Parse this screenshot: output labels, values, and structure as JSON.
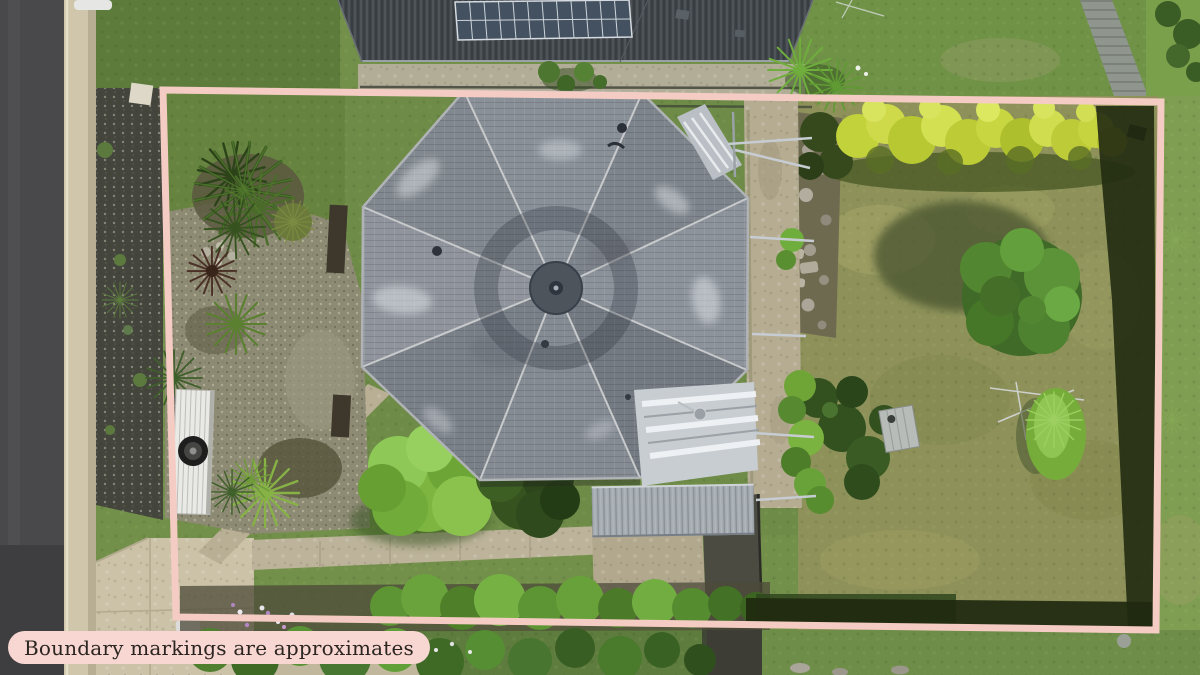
{
  "overlay": {
    "boundary_label": "Boundary markings are approximates",
    "boundary_color": "#f5ccc4",
    "label_background": "#f8d6d1",
    "label_text_color": "#2b2521"
  },
  "scene": {
    "palette": {
      "road_asphalt": "#49494b",
      "curb_concrete": "#cfc6ac",
      "lawn_green": "#72904a",
      "backyard_olive": "#8e925a",
      "octagon_roof_gray": "#868c94",
      "neighbor_roof_charcoal": "#40464b",
      "solar_panel_blue": "#445160",
      "metal_roof_silver": "#a5acb2",
      "concrete_path_tan": "#bcb39a",
      "hedge_yellow_green": "#c2d23b",
      "tree_dark_green": "#3f6a28",
      "fence_shadow_dark": "#222b12",
      "carport_white": "#e9e9e6"
    }
  }
}
